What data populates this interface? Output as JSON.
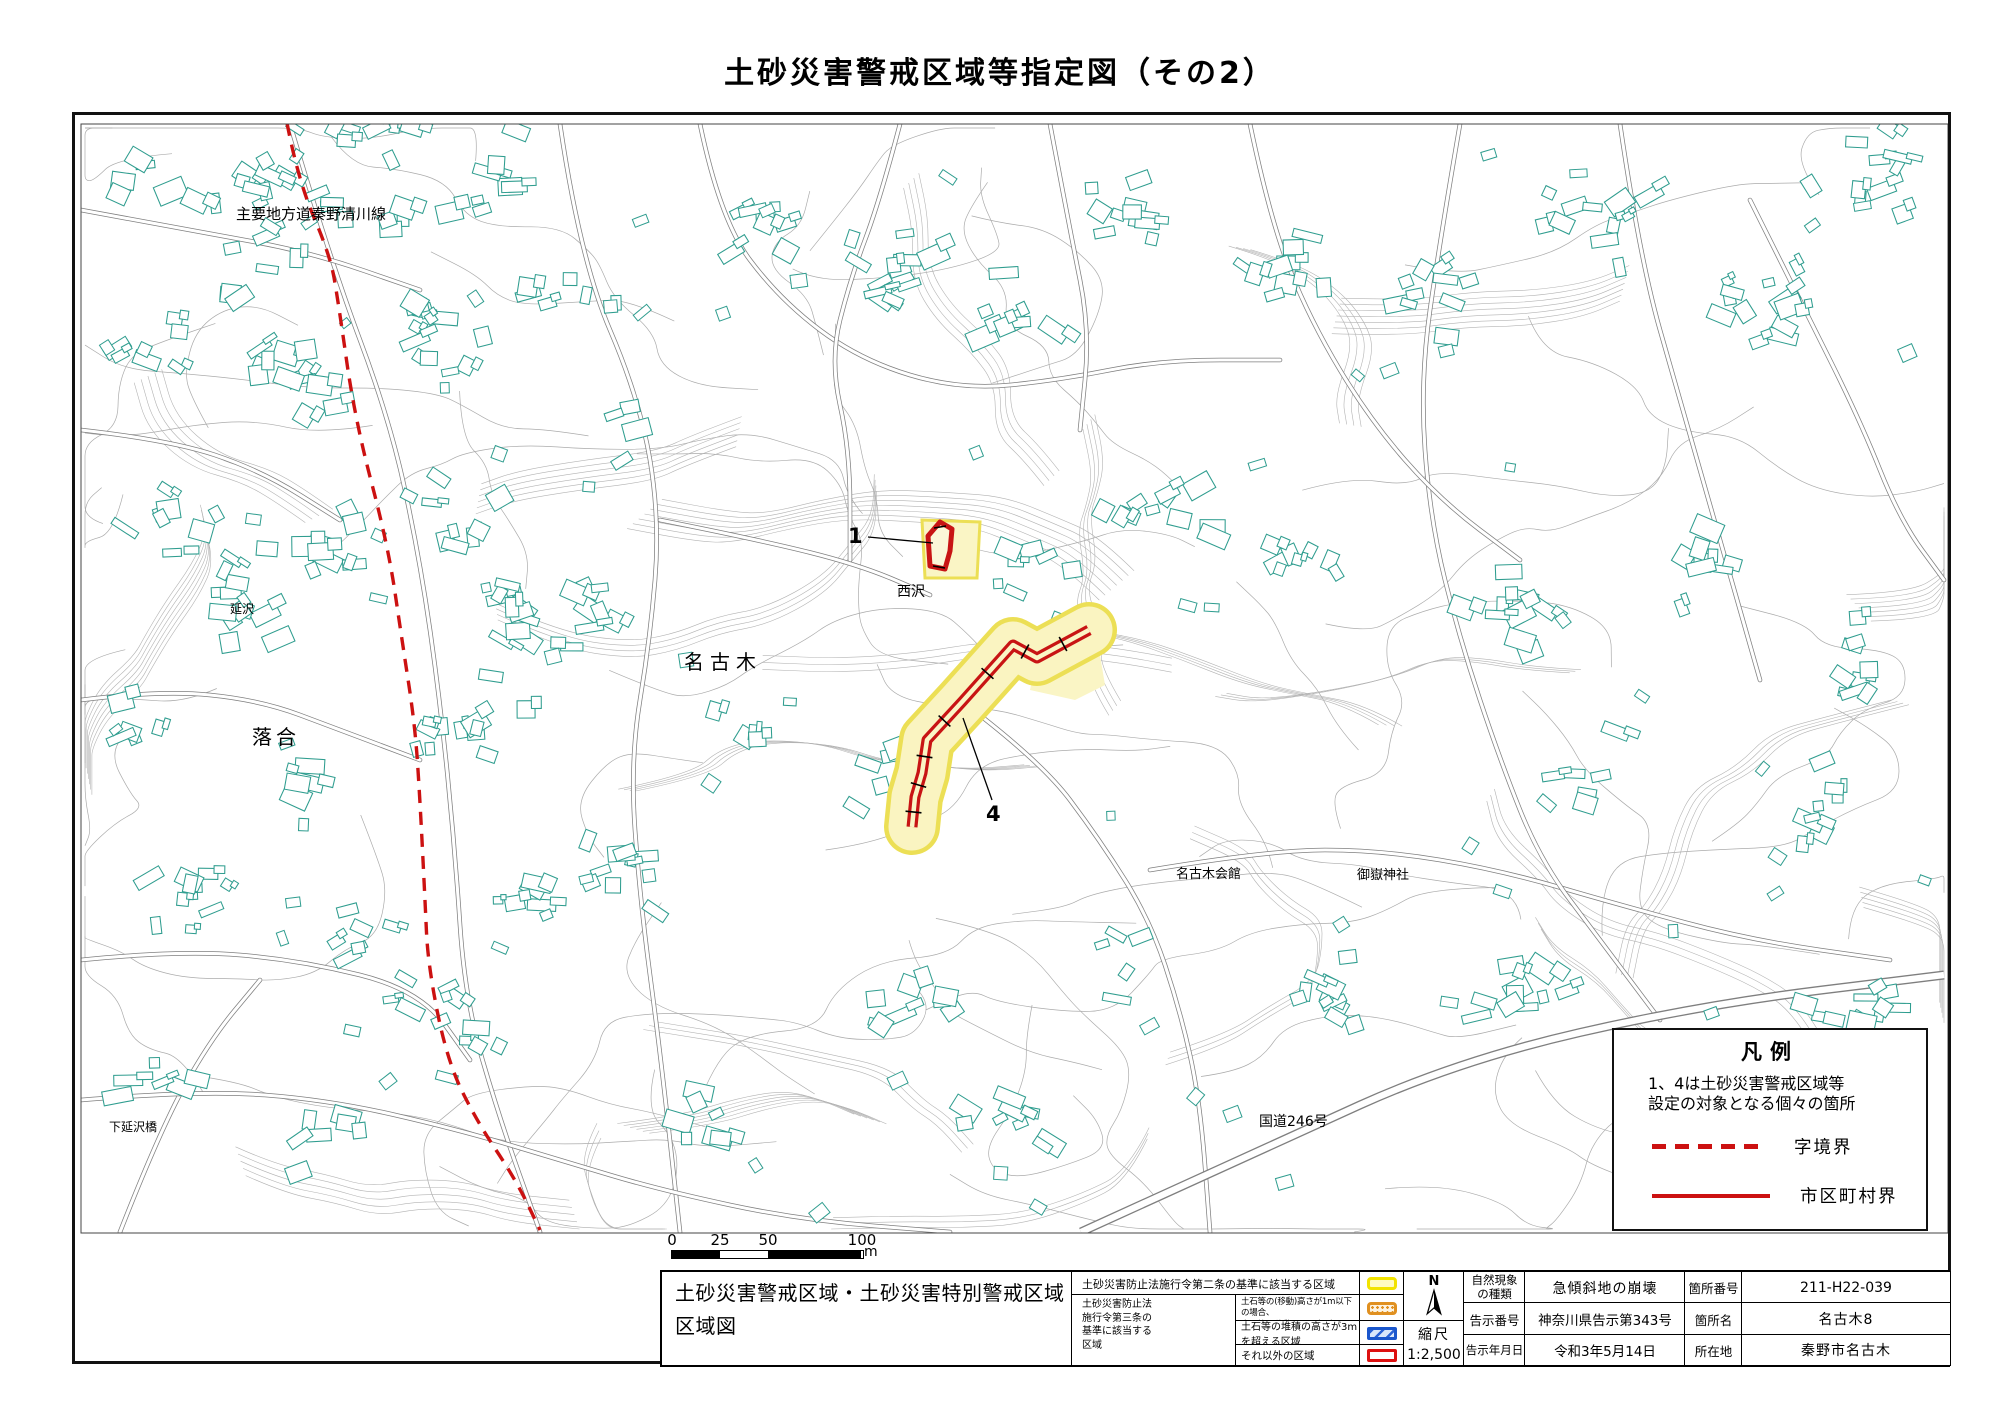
{
  "title": "土砂災害警戒区域等指定図（その2）",
  "map": {
    "place_labels": [
      {
        "text": "主要地方道秦野清川線"
      },
      {
        "text": "延沢"
      },
      {
        "text": "落合"
      },
      {
        "text": "名古木"
      },
      {
        "text": "西沢"
      },
      {
        "text": "下延沢橋"
      },
      {
        "text": "名古木会館"
      },
      {
        "text": "御嶽神社"
      },
      {
        "text": "国道246号"
      }
    ],
    "zone_markers": [
      {
        "label": "1"
      },
      {
        "label": "4"
      }
    ]
  },
  "legend_box": {
    "title": "凡例",
    "note_line1": "1、4は土砂災害警戒区域等",
    "note_line2": "設定の対象となる個々の箇所",
    "items": [
      {
        "label": "字境界",
        "style": "red-dashed"
      },
      {
        "label": "市区町村界",
        "style": "red-solid"
      }
    ]
  },
  "scale_bar": {
    "ticks": [
      "0",
      "25",
      "50",
      "100"
    ],
    "unit": "m"
  },
  "info_table": {
    "doc_title_line1": "土砂災害警戒区域・土砂災害特別警戒区域",
    "doc_title_line2": "区域図",
    "zone_legend": {
      "row1": "土砂災害防止法施行令第二条の基準に該当する区域",
      "group_label_lines": [
        "土砂災害防止法",
        "施行令第三条の",
        "基準に該当する",
        "区域"
      ],
      "row2_line1": "土石等の(移動)高さが1m以下の場合、",
      "row2_line2": "土石等の移動による力が100kN/m²を超える区域",
      "row3": "土石等の堆積の高さが3mを超える区域",
      "row4": "それ以外の区域"
    },
    "compass": {
      "north_label": "N",
      "scale_label": "縮尺",
      "scale_value": "1:2,500"
    },
    "details": {
      "rows": [
        [
          "自然現象の種類",
          "急傾斜地の崩壊",
          "箇所番号",
          "211-H22-039"
        ],
        [
          "告示番号",
          "神奈川県告示第343号",
          "箇所名",
          "名古木8"
        ],
        [
          "告示年月日",
          "令和3年5月14日",
          "所在地",
          "秦野市名古木"
        ]
      ]
    }
  },
  "colors": {
    "building_outline": "#2f9d8f",
    "contour_line": "#ababab",
    "contour_band": "#b3b3b3",
    "road_casing": "#7f7f7f",
    "boundary_red": "#cc1111",
    "zone_yellow_edge": "#ecdf55",
    "zone_yellow_fill": "#faf5c5",
    "zone_red": "#c81414",
    "swatch_yellow": "#f2e300",
    "swatch_orange": "#e09020",
    "swatch_blue": "#1a56cc",
    "swatch_red": "#dd1111"
  }
}
